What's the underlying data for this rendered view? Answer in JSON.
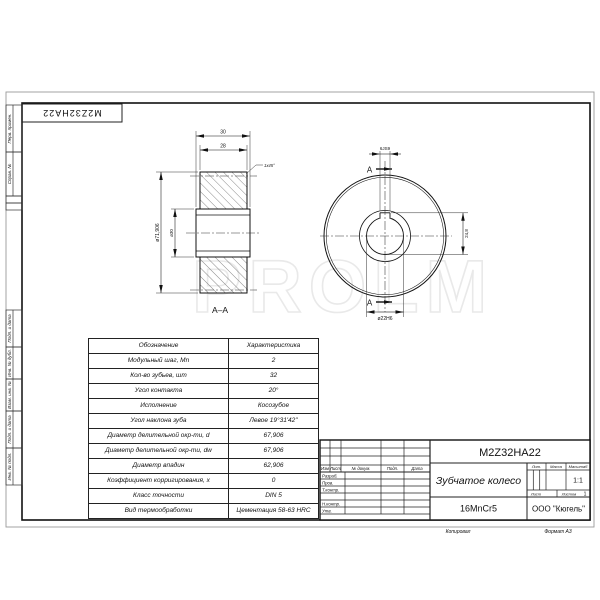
{
  "sheet": {
    "watermark": "PROLM",
    "stamp_rotated": "M2Z32HA22",
    "margin_labels": [
      "Перв. примен.",
      "Справ. №",
      "Подп. и дата",
      "Инв. № дубл.",
      "Взам. инв. №",
      "Подп. и дата",
      "Инв. № подл."
    ],
    "footer": {
      "copied": "Копировал",
      "format": "Формат  А3"
    }
  },
  "views": {
    "section": {
      "label": "А–А",
      "dim_width_outer": "30",
      "dim_width_rim": "28",
      "dim_tip": "ø71,906",
      "dim_hub": "ø30",
      "chamfer_note": "1x45°"
    },
    "front": {
      "mark_top": "А",
      "mark_bottom": "А",
      "dim_keyway_width": "6JS9",
      "dim_keyway_depth": "24,8",
      "dim_bore": "ø22H6"
    }
  },
  "spec_table": {
    "headers": [
      "Обозначение",
      "Характеристика"
    ],
    "rows": [
      [
        "Модульный шаг, Mn",
        "2"
      ],
      [
        "Кол-во зубьев, шт",
        "32"
      ],
      [
        "Угол контакта",
        "20°"
      ],
      [
        "Исполнение",
        "Косозубое"
      ],
      [
        "Угол наклона зуба",
        "Левое 19°31'42\""
      ],
      [
        "Диаметр делительной окр-ти, d",
        "67,906"
      ],
      [
        "Диаметр делительной окр-ти, dw",
        "67,906"
      ],
      [
        "Диаметр впадин",
        "62,906"
      ],
      [
        "Коэффициент корригирования, х",
        "0"
      ],
      [
        "Класс точности",
        "DIN 5"
      ],
      [
        "Вид термообработки",
        "Цементация 58-63 HRC"
      ]
    ]
  },
  "title_block": {
    "designation": "M2Z32HA22",
    "part_name": "Зубчатое колесо",
    "material": "16MnCr5",
    "company": "ООО \"Кюгель\"",
    "scale_value": "1:1",
    "lit_label": "Лит.",
    "mass_label": "Масса",
    "scale_label": "Масштаб",
    "sheet_label": "Лист",
    "sheets_label": "Листов",
    "sheets_value": "1",
    "change_header": {
      "izm": "Изм",
      "list": "Лист",
      "doc": "№ докум.",
      "sign": "Подп.",
      "date": "Дата"
    },
    "sign_labels": [
      "Разраб.",
      "Пров.",
      "Т.контр.",
      "Н.контр.",
      "Утв."
    ]
  }
}
